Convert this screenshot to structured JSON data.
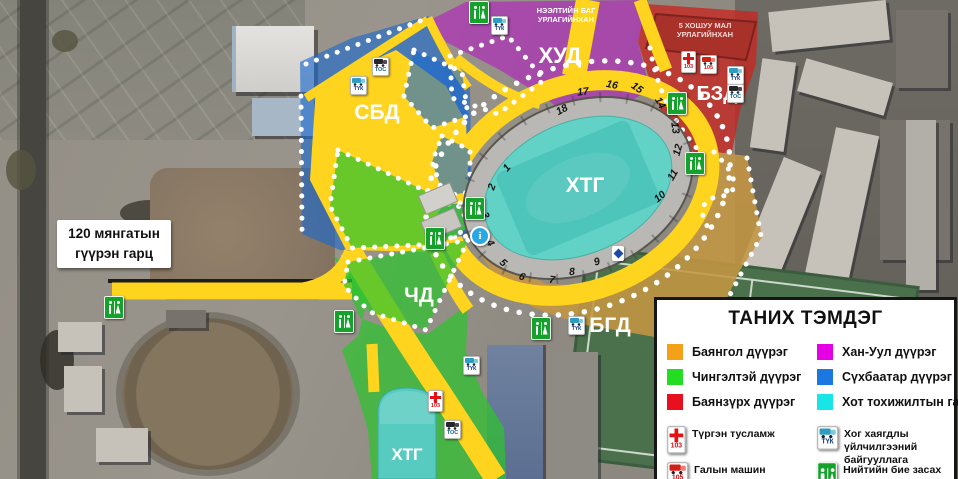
{
  "map": {
    "district_labels": {
      "sbd": "СБД",
      "khud": "ХУД",
      "bzd": "БЗД",
      "chd": "ЧД",
      "bgd": "БГД"
    },
    "stadium_label": "ХТГ",
    "south_stadium_label": "ХТГ",
    "area_notes": {
      "opening_line1": "НЭЭЛТИЙН БАГ",
      "opening_line2": "УРЛАГИЙНХАН",
      "khoshuu_line1": "5 ХОШУУ МАЛ",
      "khoshuu_line2": "УРЛАГИЙНХАН"
    },
    "bridge_note": {
      "line1": "120 мянгатын",
      "line2": "гүүрэн гарц"
    },
    "gates": [
      "1",
      "2",
      "3",
      "4",
      "5",
      "6",
      "7",
      "8",
      "9",
      "10",
      "11",
      "12",
      "13",
      "14",
      "15",
      "16",
      "17",
      "18"
    ],
    "icon_labels": {
      "tuk": "ТҮК",
      "tos": "ТОС",
      "ambulance": "103",
      "fire": "105",
      "info": "i"
    }
  },
  "legend": {
    "title": "ТАНИХ ТЭМДЭГ",
    "districts": [
      {
        "label": "Баянгол дүүрэг",
        "color": "#F5A019"
      },
      {
        "label": "Чингэлтэй дүүрэг",
        "color": "#22DD22"
      },
      {
        "label": "Баянзүрх дүүрэг",
        "color": "#E8101E"
      },
      {
        "label": "Хан-Уул дүүрэг",
        "color": "#E600E6"
      },
      {
        "label": "Сүхбаатар дүүрэг",
        "color": "#1A78E0"
      },
      {
        "label": "Хот тохижилтын газар",
        "color": "#18E6E6"
      }
    ],
    "services": [
      {
        "icon": "ambulance-103-icon",
        "label": "Түргэн тусламж"
      },
      {
        "icon": "fire-truck-105-icon",
        "label": "Галын машин"
      },
      {
        "icon": "waste-truck-tuk-icon",
        "label": "Хог хаягдлы үйлчилгээний байгууллага"
      },
      {
        "icon": "public-toilet-wc-icon",
        "label": "Нийтийн бие засах газар"
      }
    ]
  },
  "colors": {
    "road": "#FFD41E"
  }
}
